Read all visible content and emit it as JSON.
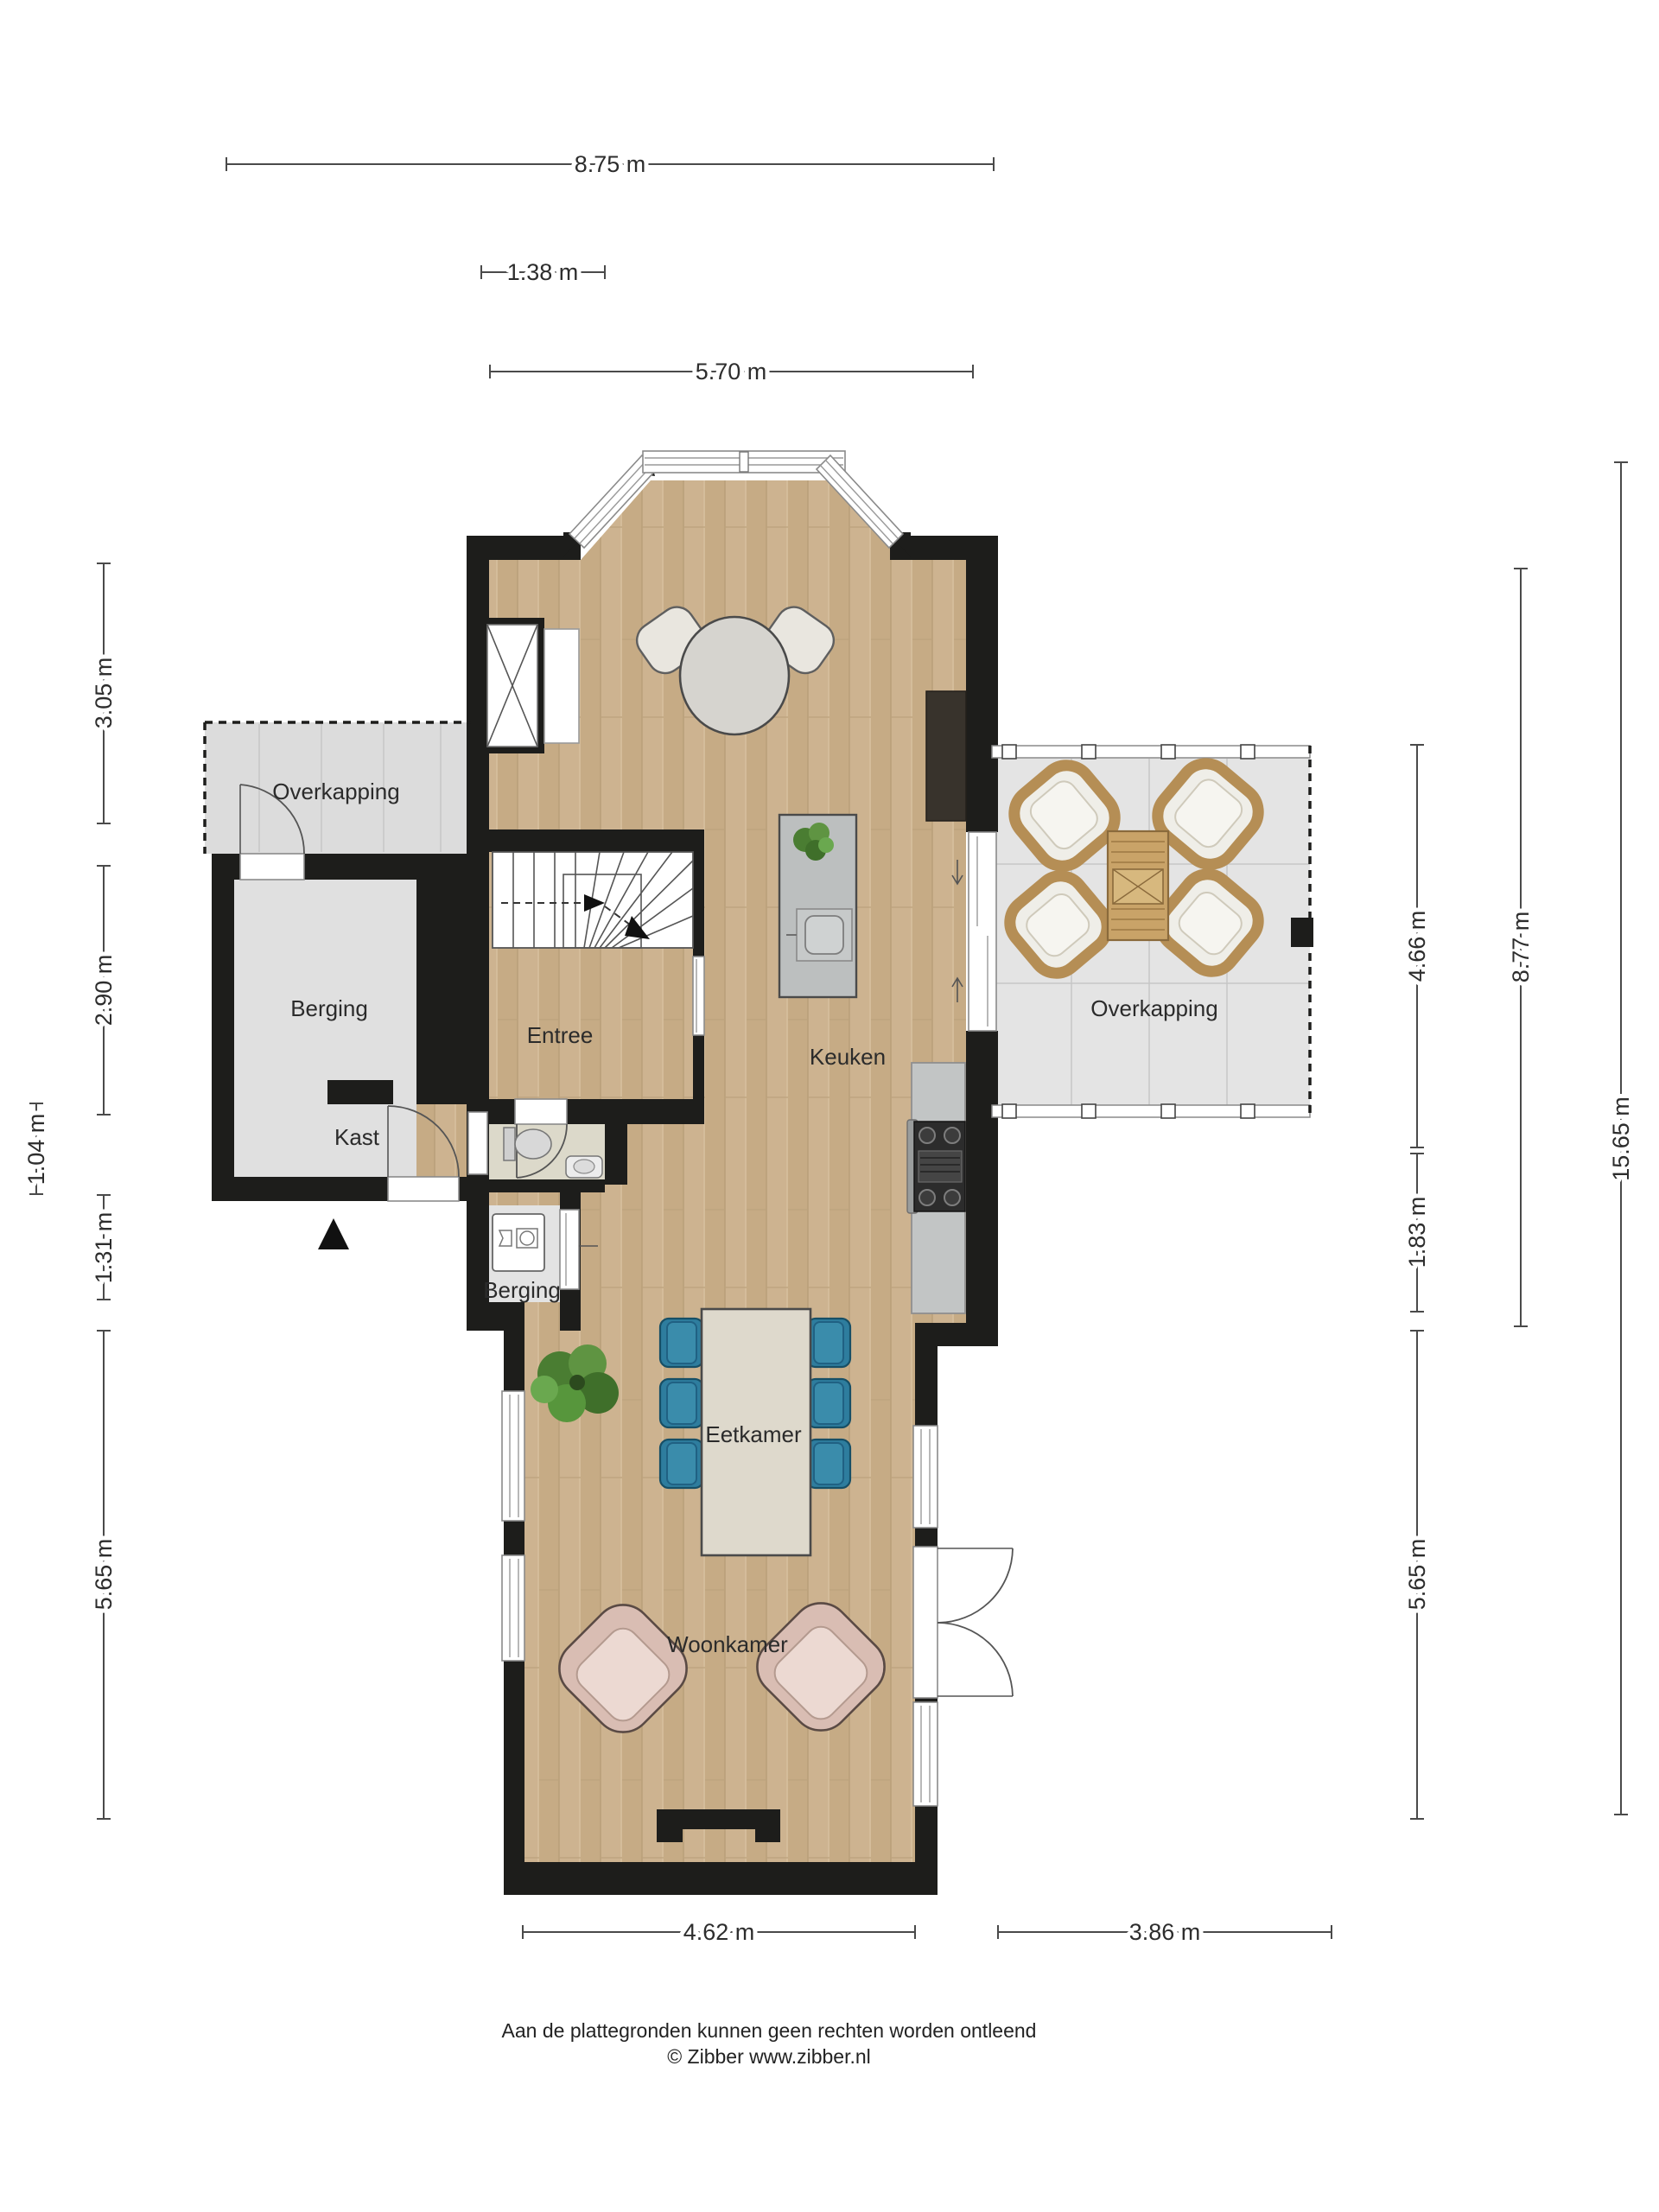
{
  "rooms": {
    "overkapping_left": "Overkapping",
    "berging_left": "Berging",
    "kast": "Kast",
    "entree": "Entree",
    "keuken": "Keuken",
    "overkapping_right": "Overkapping",
    "berging_small": "Berging",
    "eetkamer": "Eetkamer",
    "woonkamer": "Woonkamer"
  },
  "dimensions": {
    "top": [
      {
        "label": "8.75 m"
      },
      {
        "label": "1.38 m"
      },
      {
        "label": "5.70 m"
      }
    ],
    "left": [
      {
        "label": "3.05 m"
      },
      {
        "label": "2.90 m"
      },
      {
        "label": "1.04 m"
      },
      {
        "label": "1.31 m"
      },
      {
        "label": "5.65 m"
      }
    ],
    "right": [
      {
        "label": "4.66 m"
      },
      {
        "label": "1.83 m"
      },
      {
        "label": "5.65 m"
      },
      {
        "label": "8.77 m"
      },
      {
        "label": "15.65 m"
      }
    ],
    "bottom": [
      {
        "label": "4.62 m"
      },
      {
        "label": "3.86 m"
      }
    ]
  },
  "footer": {
    "disclaimer": "Aan de plattegronden kunnen geen rechten worden ontleend",
    "credit": "© Zibber www.zibber.nl"
  },
  "palette": {
    "wall": "#1d1d1b",
    "wood_floor": "#cdb390",
    "terrace_gray": "#e4e4e4",
    "storage_gray": "#e0e0e0",
    "toilet_floor": "#dcd9ca",
    "dining_chair_blue": "#2e7d9e",
    "armchair_pink": "#d9bdb3",
    "terrace_wood": "#c9a368",
    "counter_gray": "#c2c5c5",
    "counter_dark": "#38332c",
    "plant_green": "#4a7d32"
  }
}
